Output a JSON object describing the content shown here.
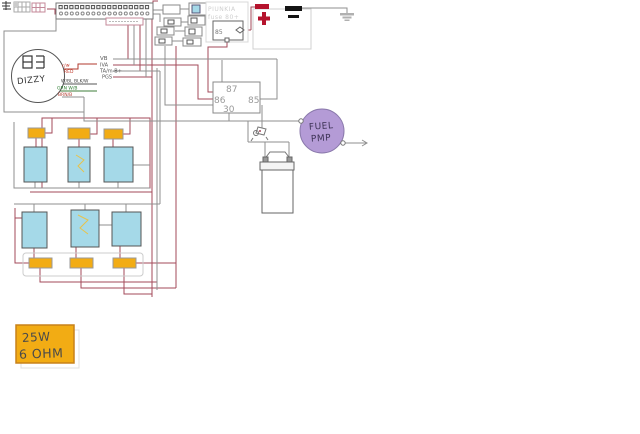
{
  "diagram": {
    "distributor": {
      "label": "DIZZY"
    },
    "wire_labels": {
      "rw": "r/w",
      "red": "RED",
      "wbl": "W/BL BLK/W",
      "grn": "GRN W/B",
      "brn": "BRN/B",
      "vb": "VB",
      "iva": "IVA",
      "ta": "TA/m-B+",
      "pgs": "PGS"
    },
    "relay": {
      "pin_top": "87",
      "pin_left": "86",
      "pin_right": "85",
      "pin_bottom": "30"
    },
    "small_relay": {
      "pin": "85"
    },
    "fuse_note": {
      "line1": "PIUNKIA",
      "line2": "fuse 80+"
    },
    "fuel_pump": {
      "line1": "FUEL",
      "line2": "PMP"
    },
    "resistor": {
      "line1": "25W",
      "line2": "6 OHM"
    },
    "colors": {
      "wire_maroon": "#a34a5a",
      "wire_gray": "#8f8f8f",
      "coil_fill": "#a5d9e8",
      "fuse_fill": "#f2ac14",
      "pump_fill": "#b49bd6",
      "battery_red": "#b5132d",
      "battery_black": "#141414"
    }
  }
}
